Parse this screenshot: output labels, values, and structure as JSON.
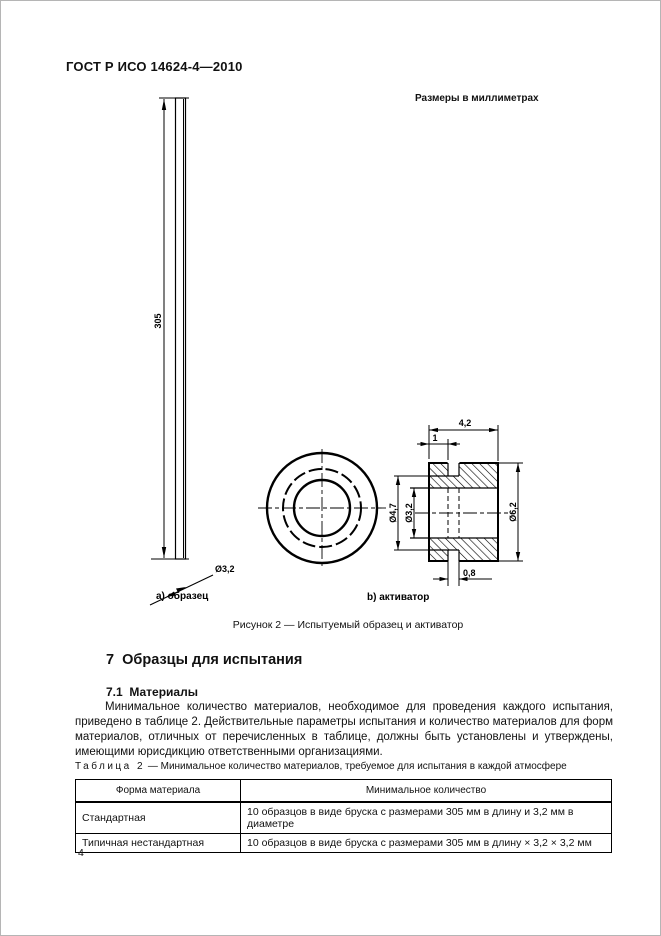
{
  "doc": {
    "header": "ГОСТ Р ИСО 14624-4—2010"
  },
  "figure": {
    "units_note": "Размеры в миллиметрах",
    "caption": "Рисунок 2 — Испытуемый образец и активатор",
    "specimen_label": "а) образец",
    "activator_label": "b) активатор",
    "dims": {
      "bar_length": "305",
      "bar_dia": "Ø3,2",
      "act_width": "4,2",
      "act_flange": "1",
      "act_slot": "0,8",
      "d_outer": "Ø6,2",
      "d_groove": "Ø4,7",
      "d_bore": "Ø3,2"
    }
  },
  "section": {
    "heading": "7  Образцы для испытания",
    "subheading": "7.1  Материалы",
    "paragraph": "Минимальное количество материалов, необходимое для проведения каждого испытания, приведено в таблице 2. Действительные параметры испытания и количество материалов для форм материалов, отличных от перечисленных в таблице, должны быть установлены и утверждены, имеющими юрисдикцию ответственными организациями."
  },
  "table": {
    "label": "Таблица 2",
    "title": "— Минимальное количество материалов, требуемое для испытания в каждой атмосфере",
    "columns": [
      "Форма материала",
      "Минимальное количество"
    ],
    "rows": [
      [
        "Стандартная",
        "10 образцов в виде бруска с размерами 305 мм в длину и 3,2 мм в диаметре"
      ],
      [
        "Типичная нестандартная",
        "10 образцов в виде бруска с размерами 305 мм в длину × 3,2 × 3,2 мм"
      ]
    ]
  },
  "footer": {
    "page_number": "4"
  }
}
